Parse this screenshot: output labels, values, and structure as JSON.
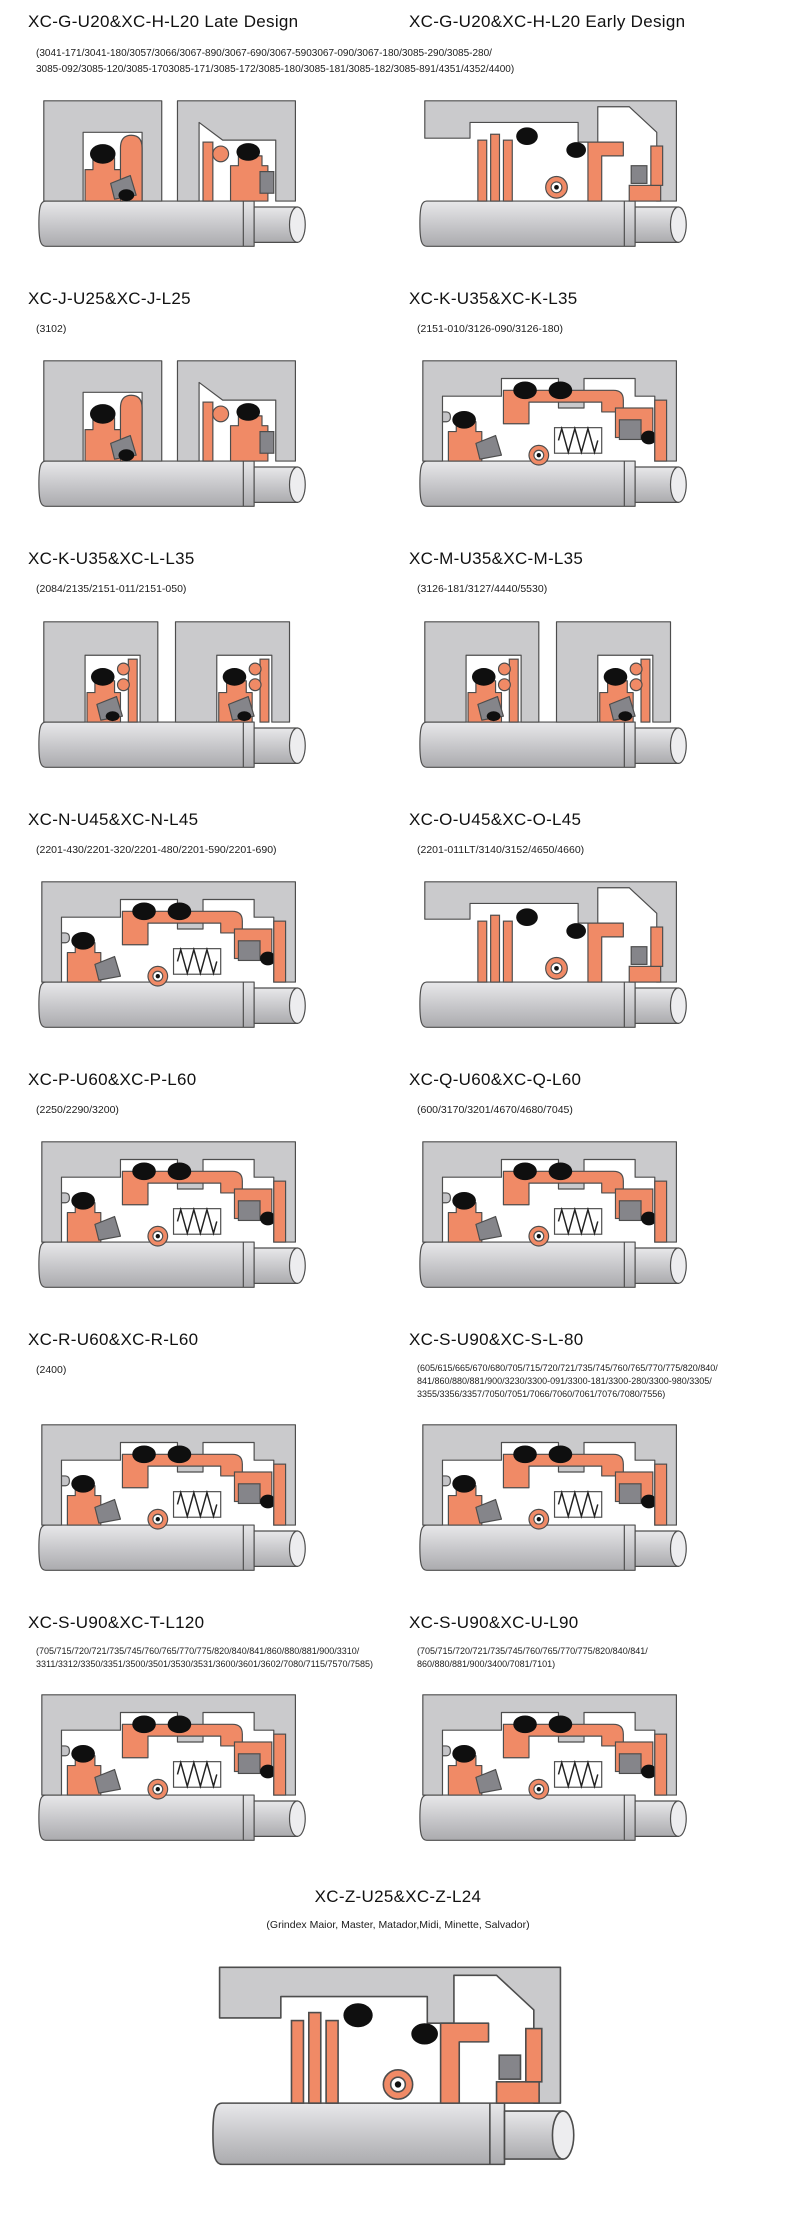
{
  "colors": {
    "seal": "#F08A66",
    "housing": "#CACACC",
    "dark": "#85858A",
    "black": "#0F0F0F",
    "outline": "#4D4D4D",
    "pin": "#C4C4C7",
    "shaft_top": "#E8E8EA",
    "shaft_mid": "#C6C6C9",
    "shaft_bottom": "#ABABAE",
    "shaft_cap": "#EDEDEF",
    "background": "#FFFFFF"
  },
  "rows": [
    {
      "left": {
        "title": "XC-G-U20&XC-H-L20 Late Design"
      },
      "right": {
        "title": "XC-G-U20&XC-H-L20 Early Design"
      },
      "shared_subtitle": "(3041-171/3041-180/3057/3066/3067-890/3067-690/3067-5903067-090/3067-180/3085-290/3085-280/\n3085-092/3085-120/3085-1703085-171/3085-172/3085-180/3085-181/3085-182/3085-891/4351/4352/4400)"
    },
    {
      "left": {
        "title": "XC-J-U25&XC-J-L25",
        "subtitle": "(3102)"
      },
      "right": {
        "title": "XC-K-U35&XC-K-L35",
        "subtitle": "(2151-010/3126-090/3126-180)"
      }
    },
    {
      "left": {
        "title": "XC-K-U35&XC-L-L35",
        "subtitle": "(2084/2135/2151-011/2151-050)"
      },
      "right": {
        "title": "XC-M-U35&XC-M-L35",
        "subtitle": "(3126-181/3127/4440/5530)"
      }
    },
    {
      "left": {
        "title": "XC-N-U45&XC-N-L45",
        "subtitle": "(2201-430/2201-320/2201-480/2201-590/2201-690)"
      },
      "right": {
        "title": "XC-O-U45&XC-O-L45",
        "subtitle": "(2201-011LT/3140/3152/4650/4660)"
      }
    },
    {
      "left": {
        "title": "XC-P-U60&XC-P-L60",
        "subtitle": "(2250/2290/3200)"
      },
      "right": {
        "title": "XC-Q-U60&XC-Q-L60",
        "subtitle": "(600/3170/3201/4670/4680/7045)"
      }
    },
    {
      "left": {
        "title": "XC-R-U60&XC-R-L60",
        "subtitle": "(2400)"
      },
      "right": {
        "title": "XC-S-U90&XC-S-L-80",
        "subtitle": "(605/615/665/670/680/705/715/720/721/735/745/760/765/770/775/820/840/\n841/860/880/881/900/3230/3300-091/3300-181/3300-280/3300-980/3305/\n3355/3356/3357/7050/7051/7066/7060/7061/7076/7080/7556)"
      }
    },
    {
      "left": {
        "title": "XC-S-U90&XC-T-L120",
        "subtitle": "(705/715/720/721/735/745/760/765/770/775/820/840/841/860/880/881/900/3310/\n3311/3312/3350/3351/3500/3501/3530/3531/3600/3601/3602/7080/7115/7570/7585)"
      },
      "right": {
        "title": "XC-S-U90&XC-U-L90",
        "subtitle": "(705/715/720/721/735/745/760/765/770/775/820/840/841/\n860/880/881/900/3400/7081/7101)"
      }
    }
  ],
  "bottom": {
    "title": "XC-Z-U25&XC-Z-L24",
    "subtitle": "(Grindex  Maior, Master, Matador,Midi, Minette, Salvador)"
  }
}
